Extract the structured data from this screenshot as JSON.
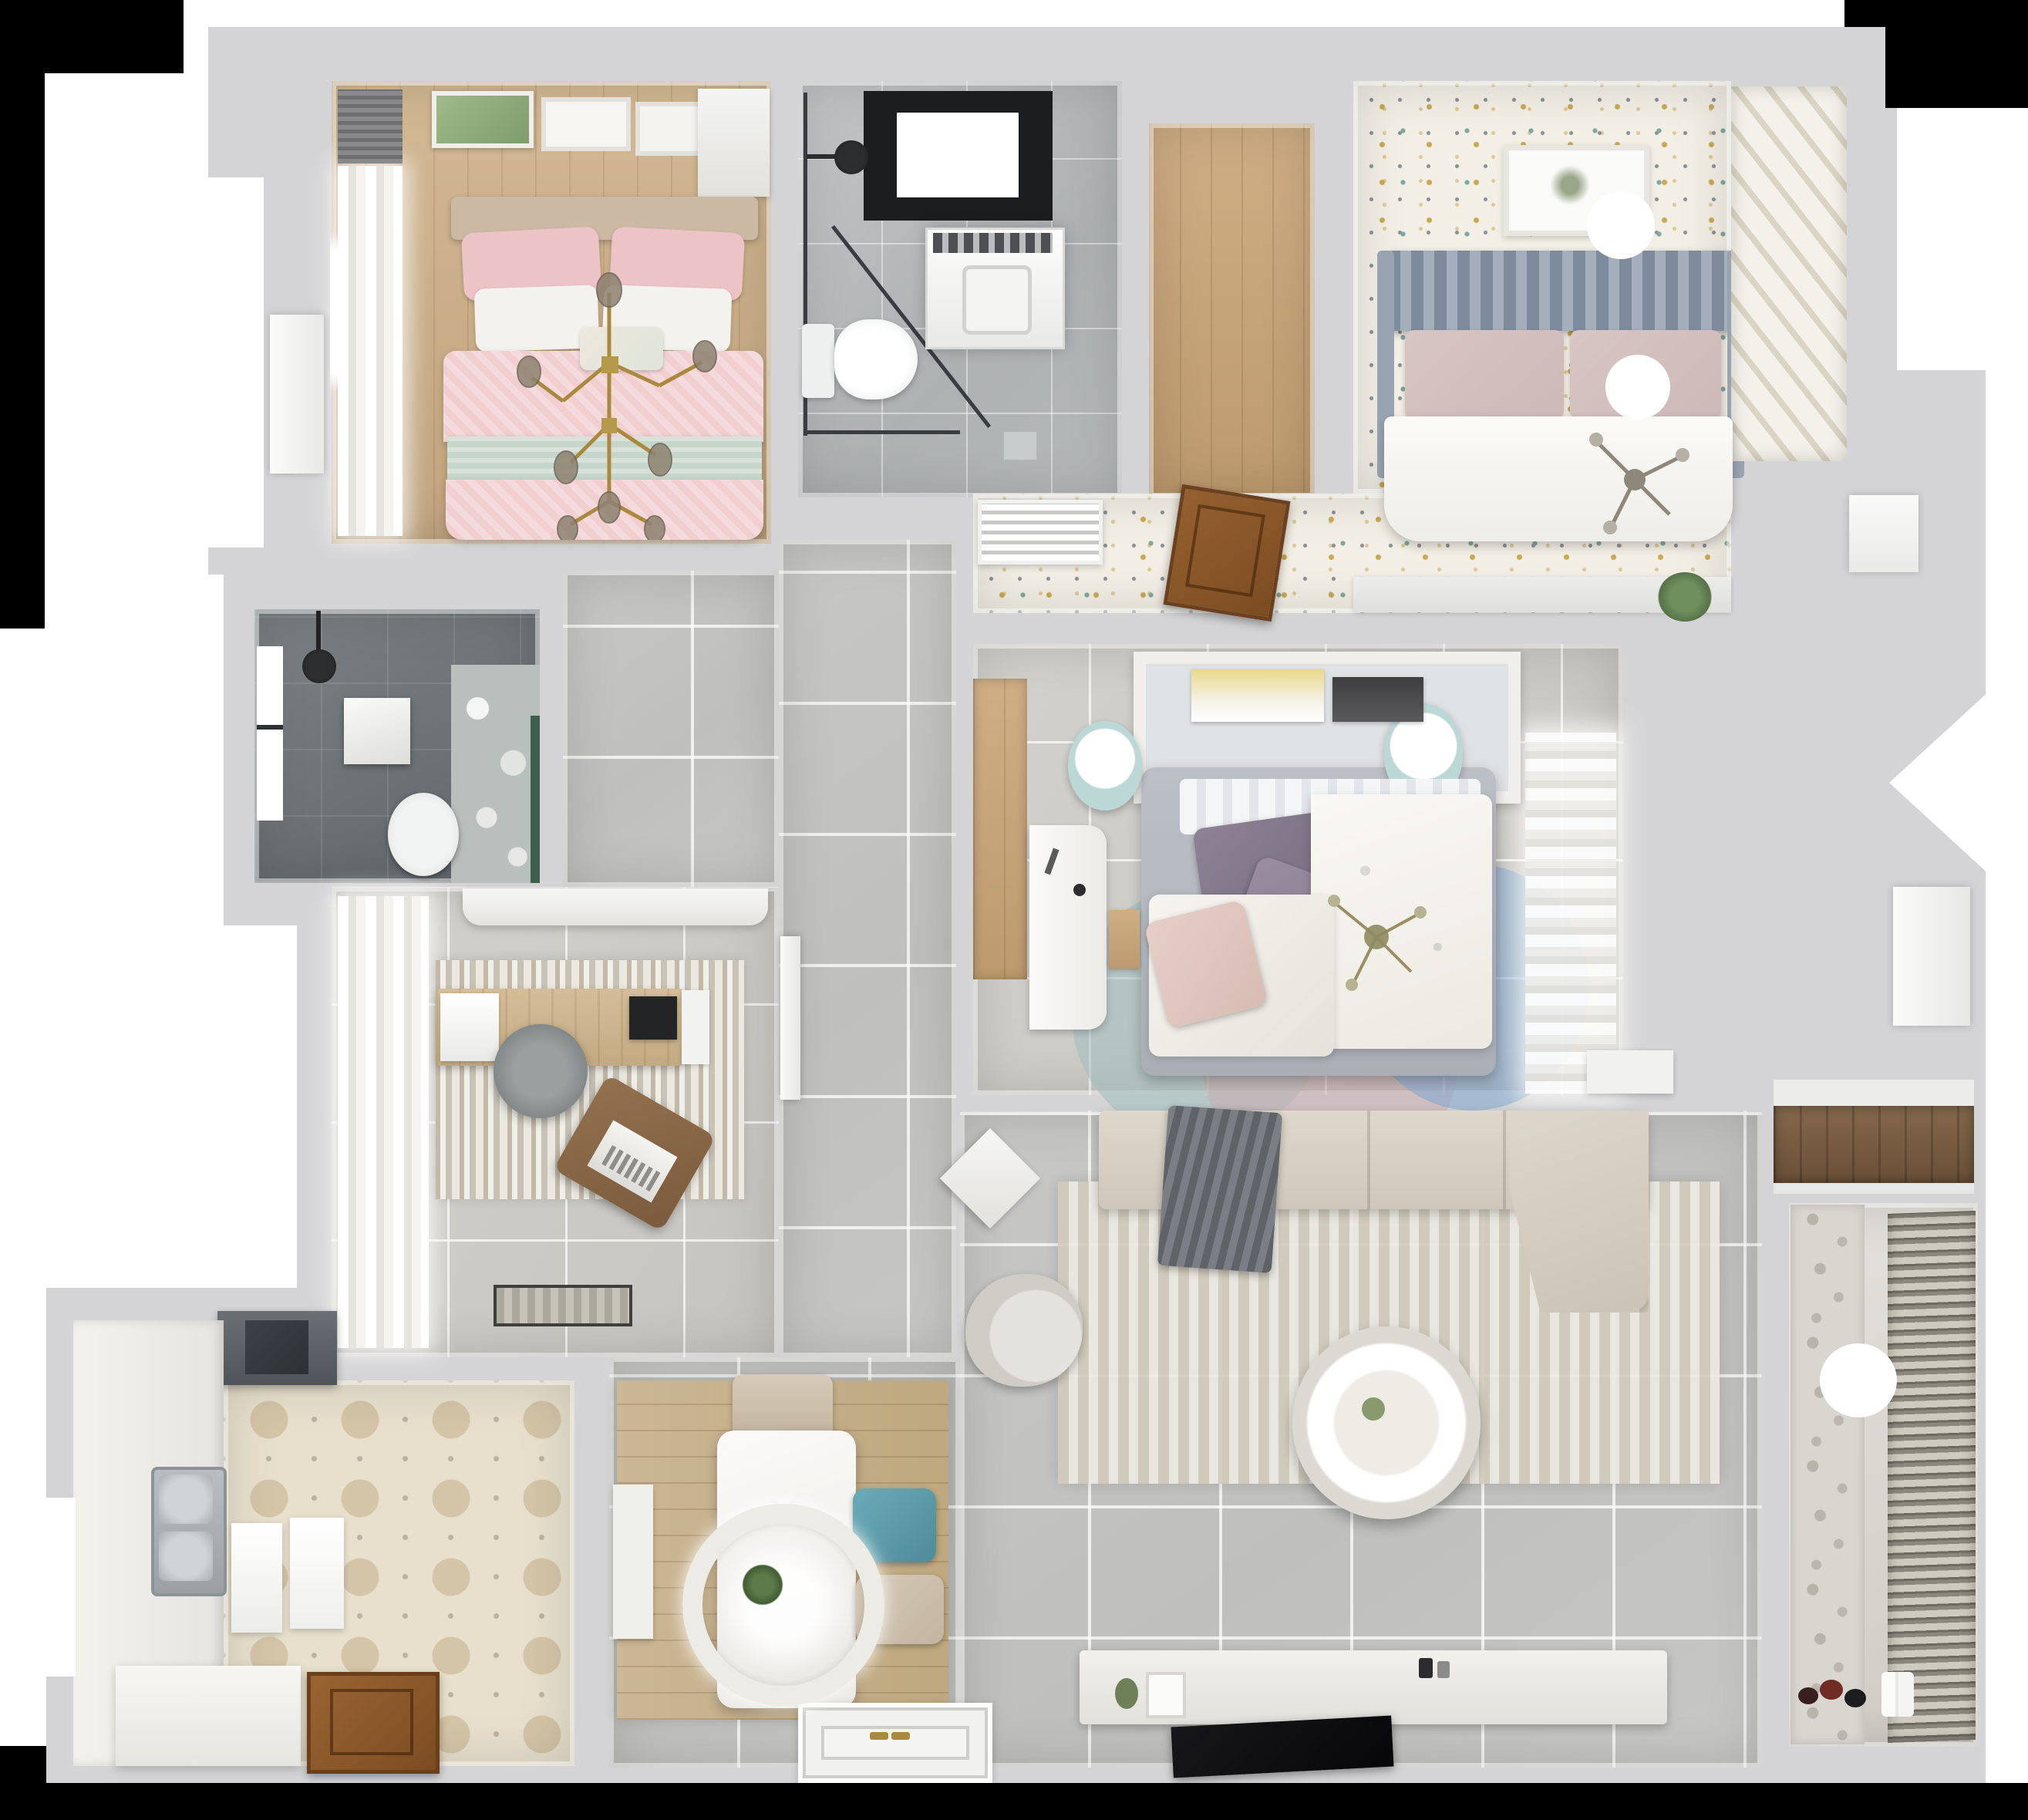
{
  "scene": {
    "kind": "3d-floorplan-top-down-render",
    "description": "Photorealistic top-down 3D render of a three-bedroom apartment floor plan, no visible text labels",
    "rooms": [
      {
        "id": "bedroom-master",
        "name": "Master bedroom (top-left)",
        "floor": "light wood plank",
        "furniture": [
          "window-curtains",
          "wall-blind",
          "wall-art-frames",
          "double-bed-pink",
          "white-pillows",
          "mint-throw-band",
          "gold-branch-chandelier",
          "wardrobe-door"
        ]
      },
      {
        "id": "bathroom-main",
        "name": "Main bathroom (top-center)",
        "floor": "gray marble tile",
        "furniture": [
          "skylight-window",
          "shower-head",
          "glass-shower-screen",
          "washing-machine",
          "toilet",
          "floor-drain"
        ]
      },
      {
        "id": "closet-hall",
        "name": "Walk-in closet / hall (top-center-right)",
        "floor": "wood plank"
      },
      {
        "id": "bedroom-guest",
        "name": "Guest bedroom (top-right)",
        "floor": "speckled terrazzo",
        "furniture": [
          "wall-art-frame",
          "slat-headboard",
          "blush-pillows",
          "ball-bedside-lamp",
          "white-duvet-bed",
          "silver-chandelier",
          "ceiling-light",
          "louvered-wardrobe",
          "air-vent-grille",
          "open-wood-door",
          "ledge-plant"
        ]
      },
      {
        "id": "bathroom-dark",
        "name": "Shower bathroom (mid-left)",
        "floor": "dark gray tile",
        "furniture": [
          "window",
          "shower-head",
          "wall-shelf",
          "toilet",
          "floral-accent-wall",
          "green-accent-strip"
        ]
      },
      {
        "id": "study",
        "name": "Study / office (mid-left)",
        "floor": "light tile",
        "furniture": [
          "sheer-curtains",
          "top-cabinet",
          "area-rug",
          "desk",
          "paper-stack",
          "monitor",
          "desk-chair",
          "lounge-chair",
          "laptop",
          "doormat",
          "door-leaf"
        ]
      },
      {
        "id": "bedroom-kids",
        "name": "Kids bedroom (center)",
        "floor": "light tile",
        "furniture": [
          "wood-wardrobe-strip",
          "headboard-shelf-books",
          "white-desk",
          "wood-drawer",
          "pouf-left",
          "pouf-right",
          "bed-gray-base",
          "floral-duvet",
          "purple-pillows",
          "blush-pillow",
          "petal-rug",
          "sheer-curtains",
          "nightstand",
          "crystal-chandelier"
        ]
      },
      {
        "id": "hallway",
        "name": "Hallway (center)",
        "floor": "gray tile"
      },
      {
        "id": "kitchen",
        "name": "Kitchen (bottom-left)",
        "floor": "hexagon tile",
        "furniture": [
          "range-hood",
          "counter-left",
          "window",
          "double-sink",
          "cutting-boards",
          "island",
          "wooden-door"
        ]
      },
      {
        "id": "dining",
        "name": "Dining area (bottom-center-left)",
        "floor": "gray tile",
        "furniture": [
          "wood-rug",
          "dining-table",
          "ring-chandelier-with-plant",
          "chair-top-beige",
          "chair-teal",
          "chair-bottom-beige",
          "bench-left"
        ]
      },
      {
        "id": "living",
        "name": "Living room (bottom-center-right)",
        "floor": "gray tile",
        "furniture": [
          "sectional-sofa",
          "chaise",
          "gray-throw",
          "side-table-diamond",
          "armchair",
          "area-rug",
          "round-coffee-table",
          "tv-console",
          "tv-flat",
          "console-decor"
        ]
      },
      {
        "id": "balcony",
        "name": "Balcony / laundry (bottom-right)",
        "floor": "light tile",
        "furniture": [
          "patterned-accent-wall",
          "venetian-blinds",
          "ceiling-light",
          "toy-cluster",
          "white-bottles"
        ]
      },
      {
        "id": "storage-niche",
        "name": "Storage niche (right)",
        "floor": "dark wood",
        "furniture": [
          "white-shelf-lip"
        ]
      },
      {
        "id": "entry",
        "name": "Entry (bottom-center)",
        "floor": "gray tile",
        "furniture": [
          "entrance-door-panel",
          "gold-door-handles"
        ]
      }
    ],
    "lights": [
      "gold-branch-chandelier",
      "silver-chandelier",
      "crystal-chandelier",
      "ball-bedside-lamp",
      "ceiling-light-guest",
      "ring-chandelier-dining",
      "ceiling-light-balcony"
    ]
  },
  "palette": {
    "page": "#ffffff",
    "black": "#000000",
    "wall": "#d4d4d6",
    "wallLight": "#e9e9eb",
    "floorGray": "#c7c7c5",
    "floorOffice": "#d3d1cc",
    "marbleA": "#c3c5c6",
    "marbleB": "#aeb1b2",
    "darkA": "#7c8184",
    "darkB": "#5f6569",
    "woodA": "#d2b893",
    "woodB": "#c0a47e",
    "woodRoomA": "#cfae85",
    "woodRoomB": "#bd9a6e",
    "speckBase": "#f3efe6",
    "speckGold": "#c9a952",
    "speckTeal": "#7fa9a0",
    "speckGray": "#8a8f96",
    "hexBase": "#e8e0cd",
    "hexShade": "#d4c5a8",
    "hexMotif": "#8d8578",
    "pink": "#f1ced0",
    "pinkDeep": "#ecc3c7",
    "mint": "#c7d6cb",
    "cream": "#f4f2ee",
    "beigeHead": "#cbb9a4",
    "gold": "#a8893e",
    "glass": "#8d8170",
    "slatHead": "#8e98a9",
    "blush": "#d8c6c4",
    "duvetWhite": "#f7f5f1",
    "tealChair": "#5f9fae",
    "chairBeige": "#cfc2b0",
    "tableWhite": "#f5f5f3",
    "sofaBeige": "#d9d2c6",
    "throwGray": "#6e7278",
    "rugLiving": "#d8d1c3",
    "rugDining": "#cbb795",
    "consoleWhite": "#edebe7",
    "tvBlack": "#0f0f11",
    "hood": "#5b6166",
    "steel": "#a9aeb2",
    "counter": "#f1efe9",
    "doorBrown": "#96602f",
    "doorBrown2": "#7c4c22",
    "purple": "#8d8193",
    "pouf": "#bcd8d6",
    "rugTealA": "#9fbdbd",
    "rugBlushA": "#c9a7ac",
    "rugBlueA": "#7ea6cf",
    "curtain": "#e6e4df",
    "accentTile": "#d9d6cf",
    "blindA": "#8c877d",
    "blindB": "#cfcabf",
    "plantGreen": "#5c7a4a",
    "artLeaf": "#9fb98a",
    "wedgeWood": "#7a5f46"
  }
}
